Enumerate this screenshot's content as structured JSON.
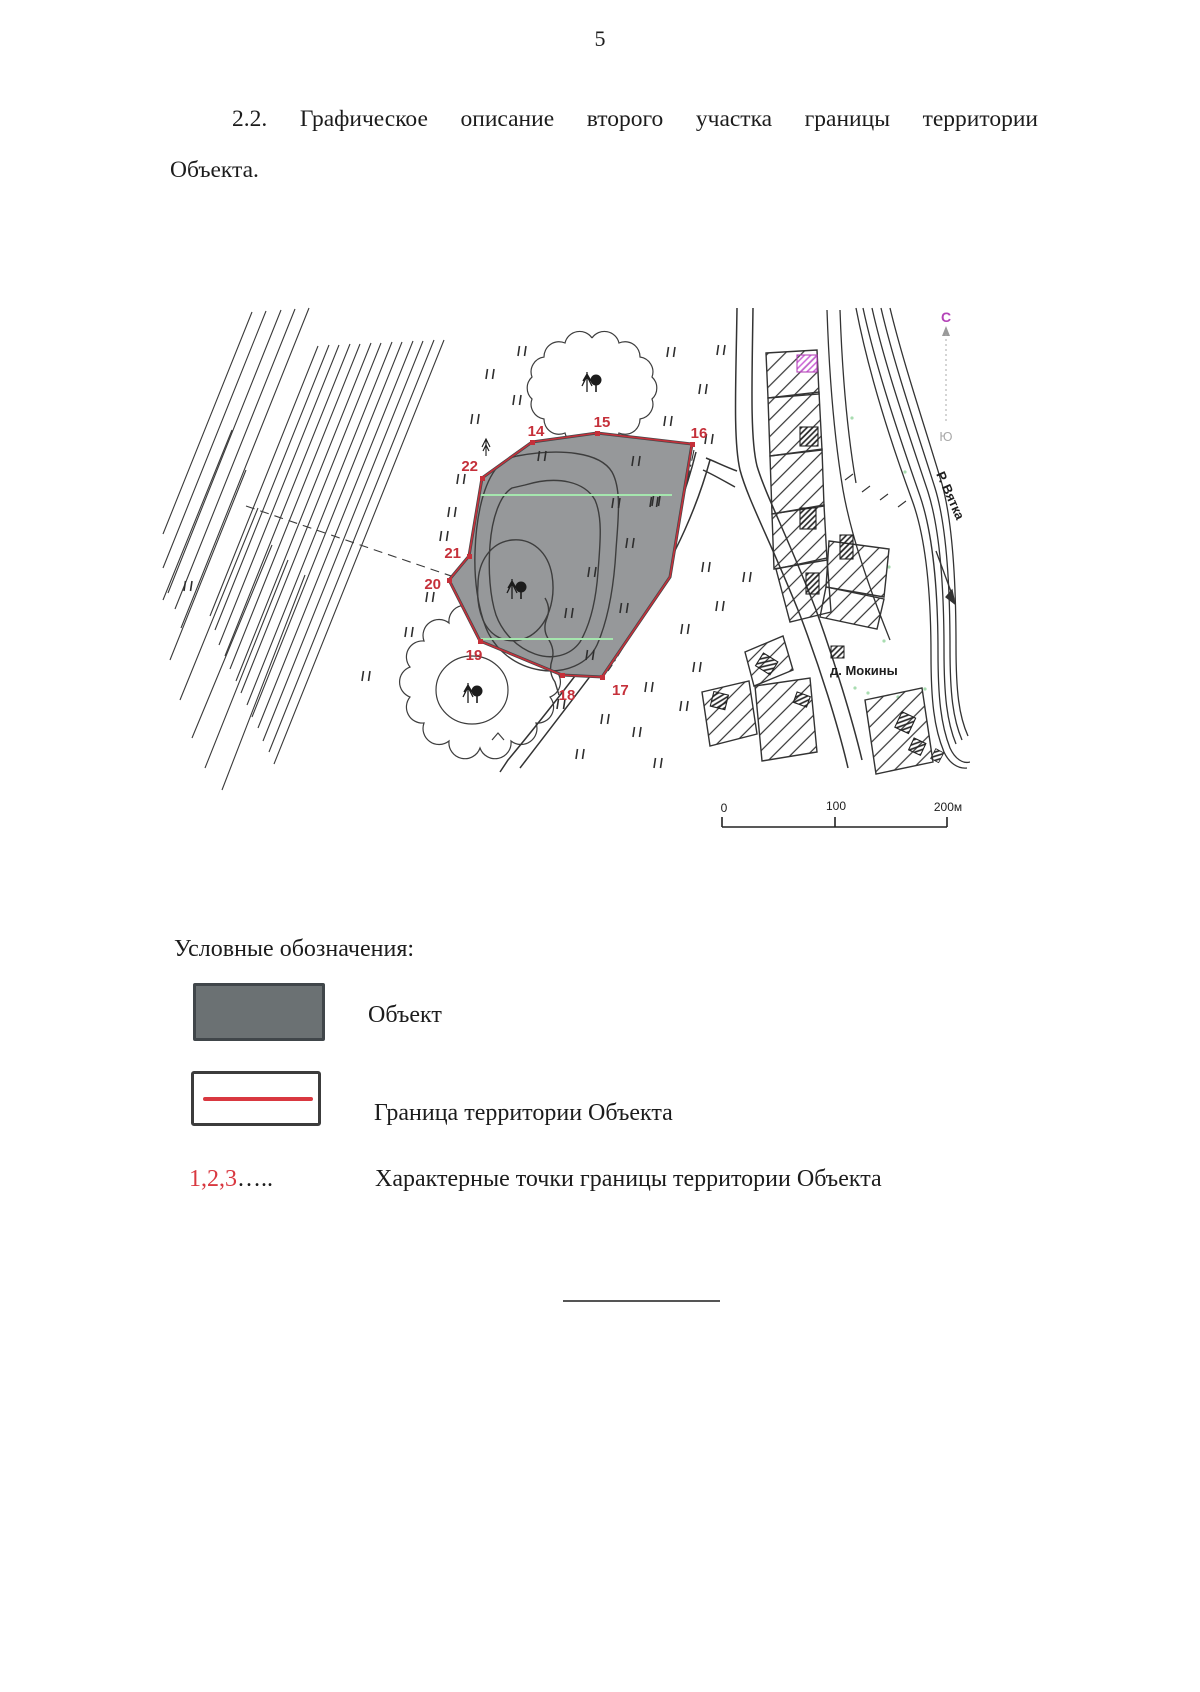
{
  "page_number": "5",
  "heading": {
    "line1": "2.2. Графическое описание второго участка границы территории",
    "line2": "Объекта."
  },
  "map": {
    "points": [
      "14",
      "15",
      "16",
      "17",
      "18",
      "19",
      "20",
      "21",
      "22"
    ],
    "village": "д. Мокины",
    "river": "Р. Вятка",
    "compass_n": "С",
    "compass_s": "Ю",
    "scale_0": "0",
    "scale_100": "100",
    "scale_200": "200м"
  },
  "legend": {
    "title": "Условные обозначения:",
    "object_label": "Объект",
    "border_label": "Граница территории Объекта",
    "points_symbol": "1,2,3",
    "points_dots": "…..",
    "points_label": "Характерные точки границы территории Объекта"
  },
  "colors": {
    "boundary_red": "#c5303a",
    "object_fill": "#96989a",
    "legend_swatch": "#6b7173",
    "compass_magenta": "#b443b8",
    "green_line": "#a5e6ae"
  }
}
